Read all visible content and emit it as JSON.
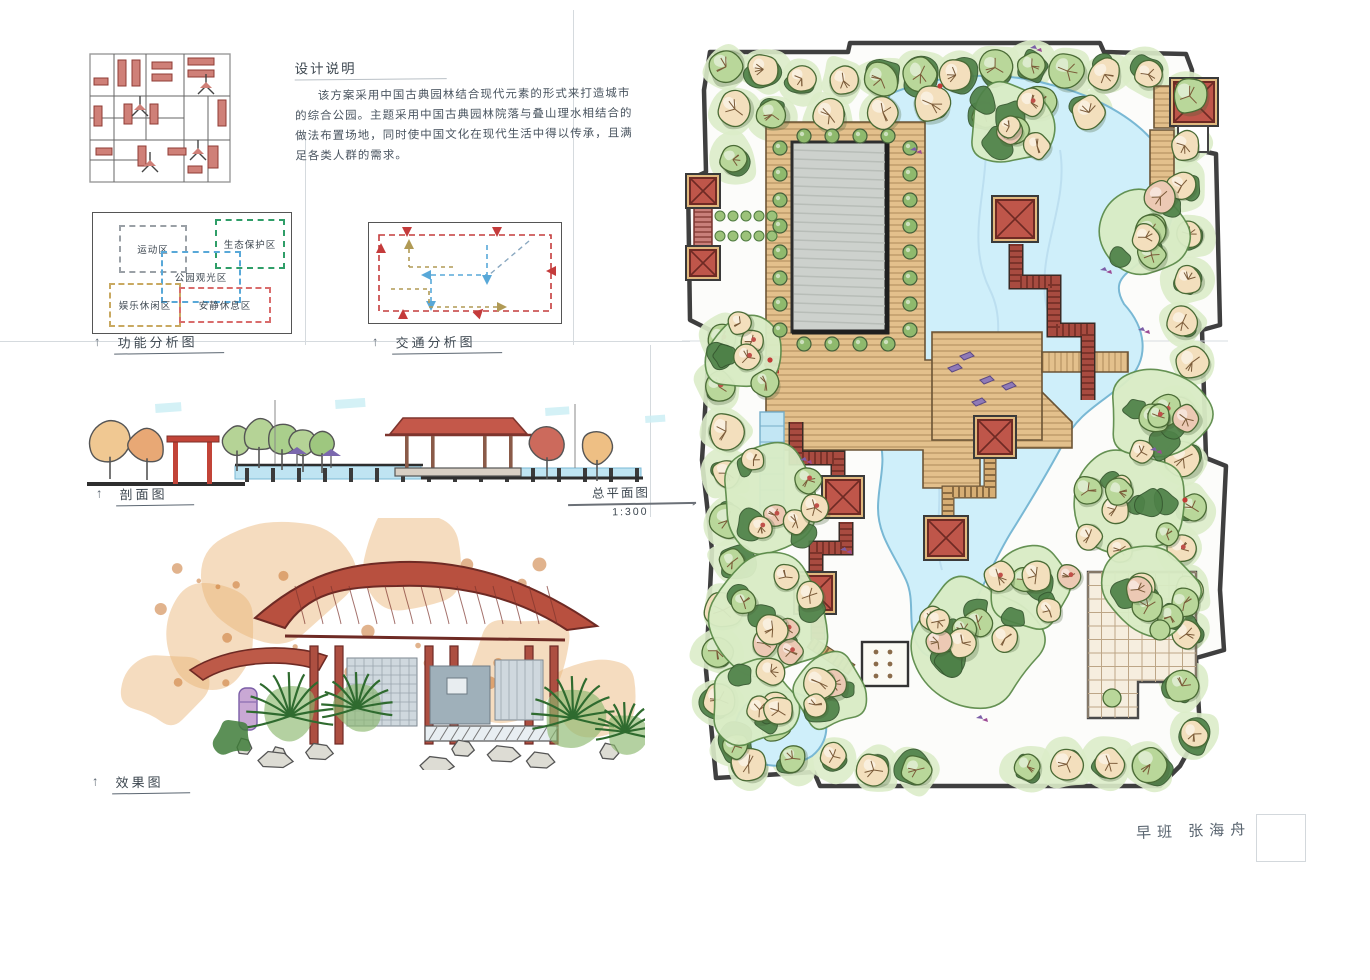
{
  "notes": {
    "title": "设计说明",
    "body": "该方案采用中国古典园林结合现代元素的形式来打造城市的综合公园。主题采用中国古典园林院落与叠山理水相结合的做法布置场地，同时使中国文化在现代生活中得以传承，且满足各类人群的需求。"
  },
  "diagrams": {
    "function": {
      "label": "功能分析图",
      "zones": [
        {
          "name": "运动区",
          "color": "#9aa0a6"
        },
        {
          "name": "生态保护区",
          "color": "#2f9e68"
        },
        {
          "name": "公园观光区",
          "color": "#58a8d8"
        },
        {
          "name": "娱乐休闲区",
          "color": "#c9a961"
        },
        {
          "name": "安静休息区",
          "color": "#d96c6c"
        }
      ]
    },
    "traffic": {
      "label": "交通分析图",
      "loop_color": "#c43b3b",
      "internal_colors": [
        "#58a8d8",
        "#b09a55"
      ]
    }
  },
  "section": {
    "label": "剖面图"
  },
  "masterplan": {
    "label": "总平面图",
    "scale": "1:300"
  },
  "perspective": {
    "label": "效果图"
  },
  "signature": "早班 张海舟",
  "icons": {
    "up_arrow": "↑",
    "right_arrow": "→"
  },
  "palette": {
    "paper": "#fdfdfb",
    "ink": "#46525c",
    "water": "#cfeaf6",
    "deck": "#e0bc85",
    "corridor": "#a84b40",
    "roof": "#bf564a",
    "canopy_cream": "#f3dfbd",
    "canopy_green": "#b9d79a",
    "hedge": "#4e8148"
  }
}
